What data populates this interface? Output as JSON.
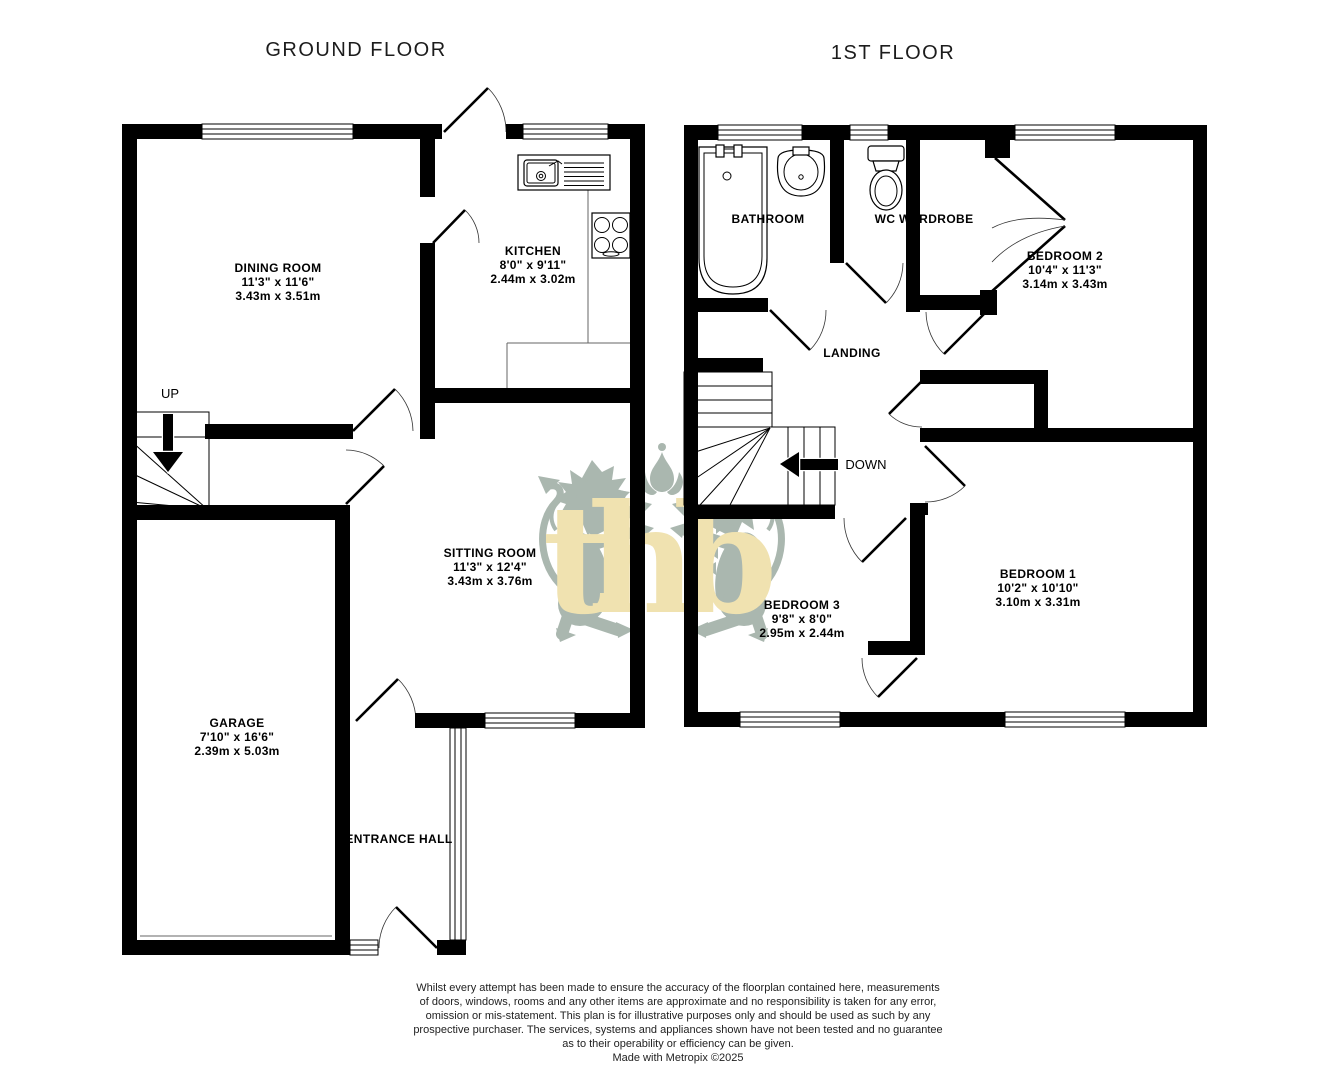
{
  "ground_floor": {
    "title": "GROUND FLOOR",
    "up_label": "UP",
    "rooms": {
      "dining": {
        "name": "DINING ROOM",
        "imperial": "11'3\"  x 11'6\"",
        "metric": "3.43m  x 3.51m"
      },
      "kitchen": {
        "name": "KITCHEN",
        "imperial": "8'0\"  x 9'11\"",
        "metric": "2.44m  x 3.02m"
      },
      "sitting": {
        "name": "SITTING ROOM",
        "imperial": "11'3\"  x 12'4\"",
        "metric": "3.43m  x 3.76m"
      },
      "garage": {
        "name": "GARAGE",
        "imperial": "7'10\"  x 16'6\"",
        "metric": "2.39m  x 5.03m"
      },
      "entrance": {
        "name": "ENTRANCE HALL"
      }
    }
  },
  "first_floor": {
    "title": "1ST FLOOR",
    "down_label": "DOWN",
    "rooms": {
      "bathroom": {
        "name": "BATHROOM"
      },
      "wc": {
        "name": "WC"
      },
      "wardrobe": {
        "name": "WARDROBE"
      },
      "landing": {
        "name": "LANDING"
      },
      "bedroom2": {
        "name": "BEDROOM 2",
        "imperial": "10'4\"  x 11'3\"",
        "metric": "3.14m  x 3.43m"
      },
      "bedroom1": {
        "name": "BEDROOM 1",
        "imperial": "10'2\"  x 10'10\"",
        "metric": "3.10m  x 3.31m"
      },
      "bedroom3": {
        "name": "BEDROOM 3",
        "imperial": "9'8\"  x 8'0\"",
        "metric": "2.95m  x 2.44m"
      }
    }
  },
  "watermark": {
    "letters": "thb",
    "lion_color": "#aab7af",
    "letter_color": "#f0e2b0"
  },
  "colors": {
    "wall": "#000000",
    "background": "#ffffff",
    "disclaimer_text": "#222222"
  },
  "footer": {
    "lines": [
      "Whilst every attempt has been made to ensure the accuracy of the floorplan contained here, measurements",
      "of doors, windows, rooms and any other items are approximate and no responsibility is taken for any error,",
      "omission or mis-statement. This plan is for illustrative purposes only and should be used as such by any",
      "prospective purchaser. The services, systems and appliances shown have not been tested and no guarantee",
      "as to their operability or efficiency can be given.",
      "Made with Metropix ©2025"
    ]
  }
}
